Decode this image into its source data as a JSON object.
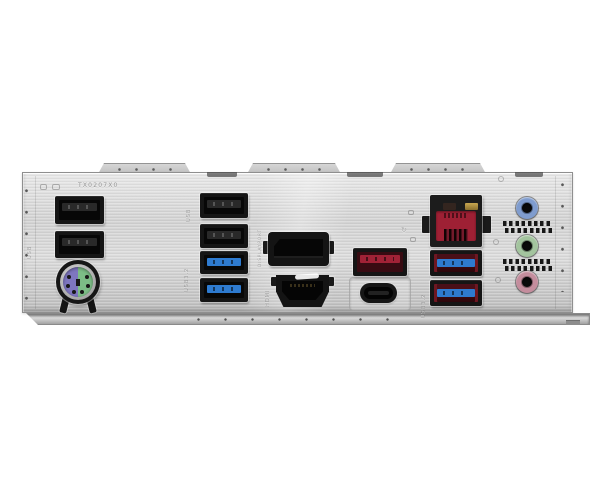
{
  "meta": {
    "description": "Photograph of a motherboard rear I/O shield panel on a white background"
  },
  "colors": {
    "metal_hi": "#e9e9e9",
    "metal_mid": "#d3d3d3",
    "metal_lo": "#bdbdbd",
    "port_black": "#151515",
    "cavity_black": "#070707",
    "usb_blue": "#2e7bd0",
    "usb_red_tongue": "#a02236",
    "usb_red_cavity": "#380b12",
    "rj45_red": "#9e2034",
    "led_gold": "#c8a750",
    "ps2_purple": "#7e76c0",
    "ps2_green": "#7cbd86",
    "audio_blue": "#7f9cce",
    "audio_green": "#a3c49e",
    "audio_pink": "#c48d9d"
  },
  "stamps": {
    "code": "TX0207X0",
    "usb_left": "USB",
    "usb_mid": "USB",
    "usb32_mid": "USB3.2",
    "displayport": "DISPLAYPORT",
    "hdmi": "HDMI",
    "usb32_right": "USB3.2",
    "refresh_glyph": "↻"
  },
  "ports": {
    "usb2_left": "two USB 2.0 Type-A ports (black)",
    "ps2": "PS/2 keyboard/mouse combo port (purple/green)",
    "usb2_mid": "two USB 2.0 Type-A ports (black)",
    "usb3_mid": "two USB 3.2 Gen1 Type-A ports (blue)",
    "displayport": "DisplayPort video output",
    "hdmi": "HDMI video output",
    "usb3_red": "USB 3.2 Gen2 Type-A port (red)",
    "usb_type_c": "USB Type-C port",
    "lan": "RJ-45 LAN port with link/activity LEDs",
    "usb3_pair_right": "two USB 3.2 Type-A ports (red housing, blue tongue)",
    "audio_jacks": [
      "line-in (blue)",
      "line-out (green)",
      "mic-in (pink)"
    ]
  }
}
